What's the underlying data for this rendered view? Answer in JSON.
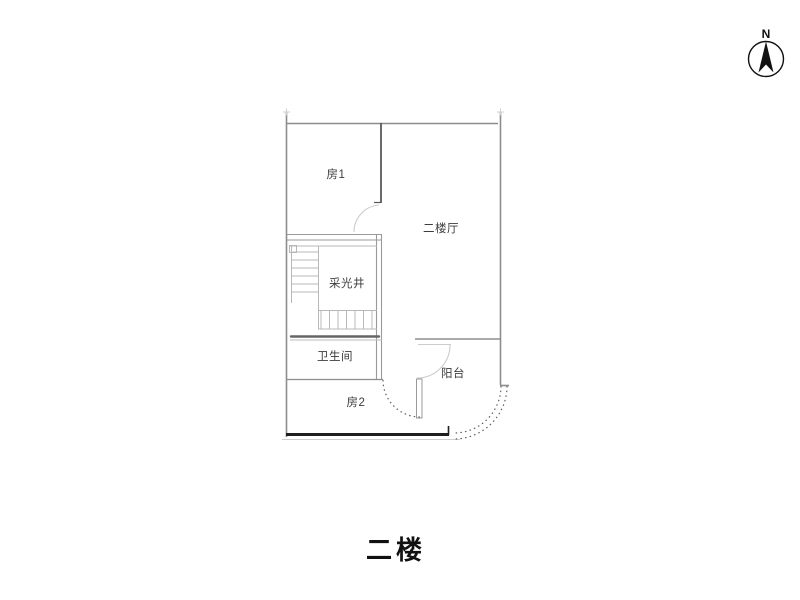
{
  "compass": {
    "label": "N"
  },
  "floor_plan": {
    "rooms": [
      {
        "id": "room1",
        "label": "房1"
      },
      {
        "id": "hall",
        "label": "二楼厅"
      },
      {
        "id": "light-well",
        "label": "采光井"
      },
      {
        "id": "bathroom",
        "label": "卫生间"
      },
      {
        "id": "room2",
        "label": "房2"
      },
      {
        "id": "balcony",
        "label": "阳台"
      }
    ]
  },
  "title": "二楼",
  "colors": {
    "wall": "#8d8d8d",
    "wall_dark": "#1e1e1e",
    "partition": "#5a5a5a",
    "stair": "#b8b8b8",
    "door_arc": "#cccccc",
    "dashed": "#5f5f5f",
    "text": "#3d3d3d"
  }
}
